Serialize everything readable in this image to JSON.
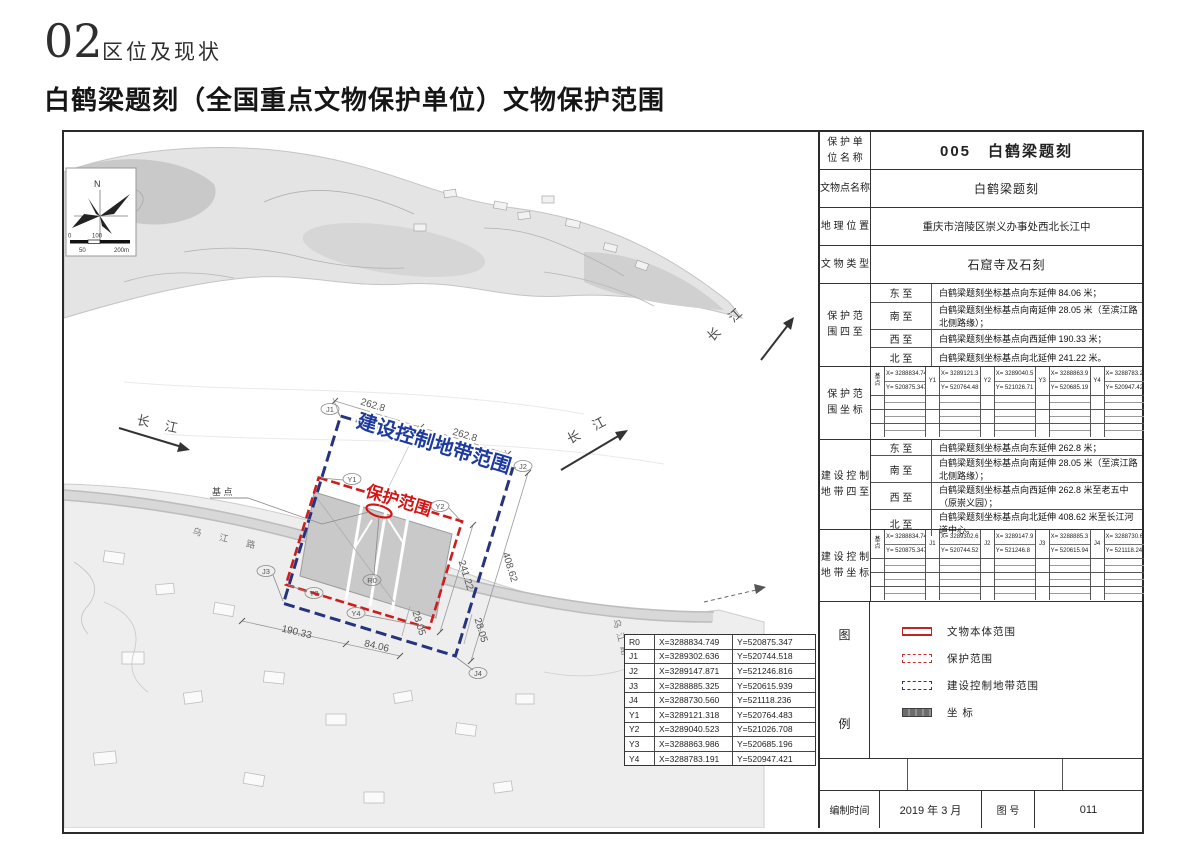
{
  "header": {
    "section_number": "02",
    "section_label": "区位及现状",
    "title": "白鹤梁题刻（全国重点文物保护单位）文物保护范围"
  },
  "panel": {
    "unit_label": "保 护 单\n位 名 称",
    "unit_value": "005　白鹤梁题刻",
    "site_label": "文物点名称",
    "site_value": "白鹤梁题刻",
    "loc_label": "地 理 位 置",
    "loc_value": "重庆市涪陵区崇义办事处西北长江中",
    "type_label": "文 物 类 型",
    "type_value": "石窟寺及石刻",
    "pb": {
      "header": "保 护 范\n围 四 至",
      "rows": [
        {
          "dir": "东 至",
          "text": "白鹤梁题刻坐标基点向东延伸 84.06 米；"
        },
        {
          "dir": "南 至",
          "text": "白鹤梁题刻坐标基点向南延伸 28.05 米（至滨江路北侧路缘）；"
        },
        {
          "dir": "西 至",
          "text": "白鹤梁题刻坐标基点向西延伸 190.33 米；"
        },
        {
          "dir": "北 至",
          "text": "白鹤梁题刻坐标基点向北延伸 241.22 米。"
        }
      ]
    },
    "pc": {
      "header": "保 护 范\n围 坐 标",
      "cells": [
        {
          "pt": "基\n点",
          "x": "X= 3288834.749",
          "y": "Y= 520875.347"
        },
        {
          "pt": "Y1",
          "x": "X= 3289121.3",
          "y": "Y= 520764.48"
        },
        {
          "pt": "Y2",
          "x": "X= 3289040.5",
          "y": "Y= 521026.71"
        },
        {
          "pt": "Y3",
          "x": "X= 3288863.9",
          "y": "Y= 520685.19"
        },
        {
          "pt": "Y4",
          "x": "X= 3288783.2",
          "y": "Y= 520947.42"
        }
      ]
    },
    "cb": {
      "header": "建 设 控 制\n地 带 四 至",
      "rows": [
        {
          "dir": "东 至",
          "text": "白鹤梁题刻坐标基点向东延伸 262.8 米；"
        },
        {
          "dir": "南 至",
          "text": "白鹤梁题刻坐标基点向南延伸 28.05 米（至滨江路北侧路缘）；"
        },
        {
          "dir": "西 至",
          "text": "白鹤梁题刻坐标基点向西延伸 262.8 米至老五中（原崇义园）；"
        },
        {
          "dir": "北 至",
          "text": "白鹤梁题刻坐标基点向北延伸 408.62 米至长江河道中心。"
        }
      ]
    },
    "cc": {
      "header": "建 设 控 制\n地 带 坐 标",
      "cells": [
        {
          "pt": "基\n点",
          "x": "X= 3288834.749",
          "y": "Y= 520875.347"
        },
        {
          "pt": "J1",
          "x": "X= 3289302.6",
          "y": "Y= 520744.52"
        },
        {
          "pt": "J2",
          "x": "X= 3289147.9",
          "y": "Y= 521246.8"
        },
        {
          "pt": "J3",
          "x": "X= 3288885.3",
          "y": "Y= 520615.94"
        },
        {
          "pt": "J4",
          "x": "X= 3288730.6",
          "y": "Y= 521118.24"
        }
      ]
    },
    "legend": {
      "header_top": "图",
      "header_bottom": "例",
      "items": [
        "文物本体范围",
        "保护范围",
        "建设控制地带范围",
        "坐 标"
      ]
    },
    "footer": {
      "date_label": "编制时间",
      "date_value": "2019 年 3 月",
      "no_label": "图  号",
      "no_value": "011"
    }
  },
  "map": {
    "colors": {
      "protect_red": "#cf1d1d",
      "control_blue": "#26337f"
    },
    "north": "N",
    "scale": {
      "t0": "0",
      "t50": "50",
      "t100": "100",
      "t200": "200m"
    },
    "river1": "长 江",
    "river2": "长 江",
    "river3": "长 江",
    "road1": "乌 江 路",
    "road2": "乌江路",
    "ctrl_zone_label": "建设控制地带范围",
    "protect_zone_label": "保护范围",
    "base_point_label": "基 点",
    "dims": {
      "top1": "262.8",
      "top2": "262.8",
      "right1": "241.22",
      "right2": "408.62",
      "bottom1": "190.33",
      "bottom2": "84.06",
      "s1": "28.05",
      "s2": "28.05"
    },
    "pts": {
      "j1": "J1",
      "j2": "J2",
      "j3": "J3",
      "j4": "J4",
      "y1": "Y1",
      "y2": "Y2",
      "y3": "Y3",
      "y4": "Y4",
      "r0": "R0"
    },
    "coords": {
      "rows": [
        [
          "R0",
          "X=3288834.749",
          "Y=520875.347"
        ],
        [
          "J1",
          "X=3289302.636",
          "Y=520744.518"
        ],
        [
          "J2",
          "X=3289147.871",
          "Y=521246.816"
        ],
        [
          "J3",
          "X=3288885.325",
          "Y=520615.939"
        ],
        [
          "J4",
          "X=3288730.560",
          "Y=521118.236"
        ],
        [
          "Y1",
          "X=3289121.318",
          "Y=520764.483"
        ],
        [
          "Y2",
          "X=3289040.523",
          "Y=521026.708"
        ],
        [
          "Y3",
          "X=3288863.986",
          "Y=520685.196"
        ],
        [
          "Y4",
          "X=3288783.191",
          "Y=520947.421"
        ]
      ]
    }
  }
}
